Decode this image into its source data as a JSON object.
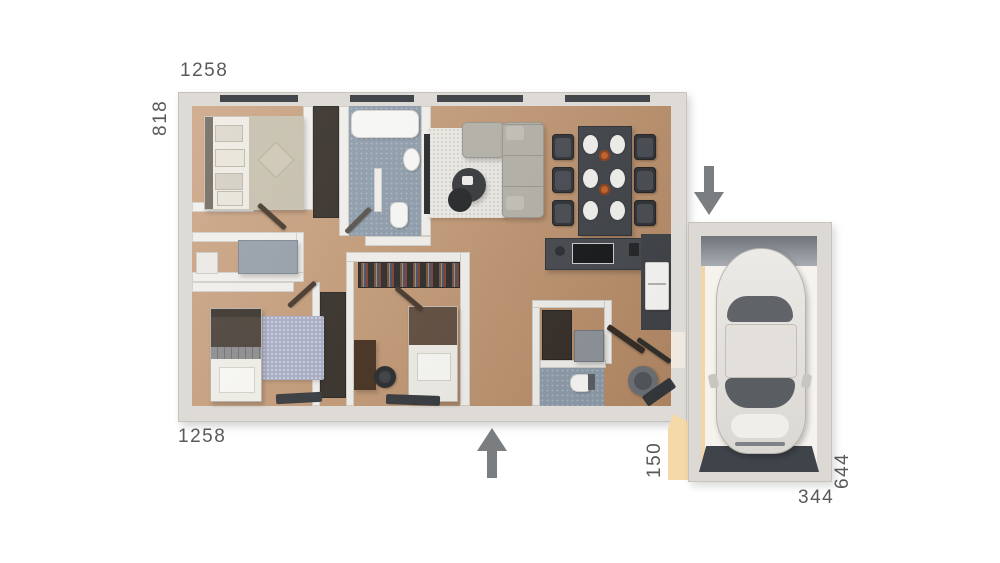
{
  "floor_plan": {
    "dimensions": {
      "top_width": "1258",
      "left_height": "818",
      "bottom_width": "1258",
      "breezeway_width": "150",
      "garage_width": "344",
      "garage_depth": "644"
    },
    "icons": {
      "entrance_top": "arrow-down-icon",
      "entrance_bottom": "arrow-up-icon"
    },
    "colors": {
      "background": "#ffffff",
      "wall": "#f3f1ed",
      "wall_edge": "#d3d0cb",
      "wood_floor": "#c39a76",
      "bathroom_floor": "#8e9cab",
      "dark_furniture": "#404449",
      "label_text": "#5a5a5a",
      "arrow": "#7b7e80",
      "breezeway_accent": "#f5d9a9",
      "car_body": "#e9e7e3"
    }
  }
}
